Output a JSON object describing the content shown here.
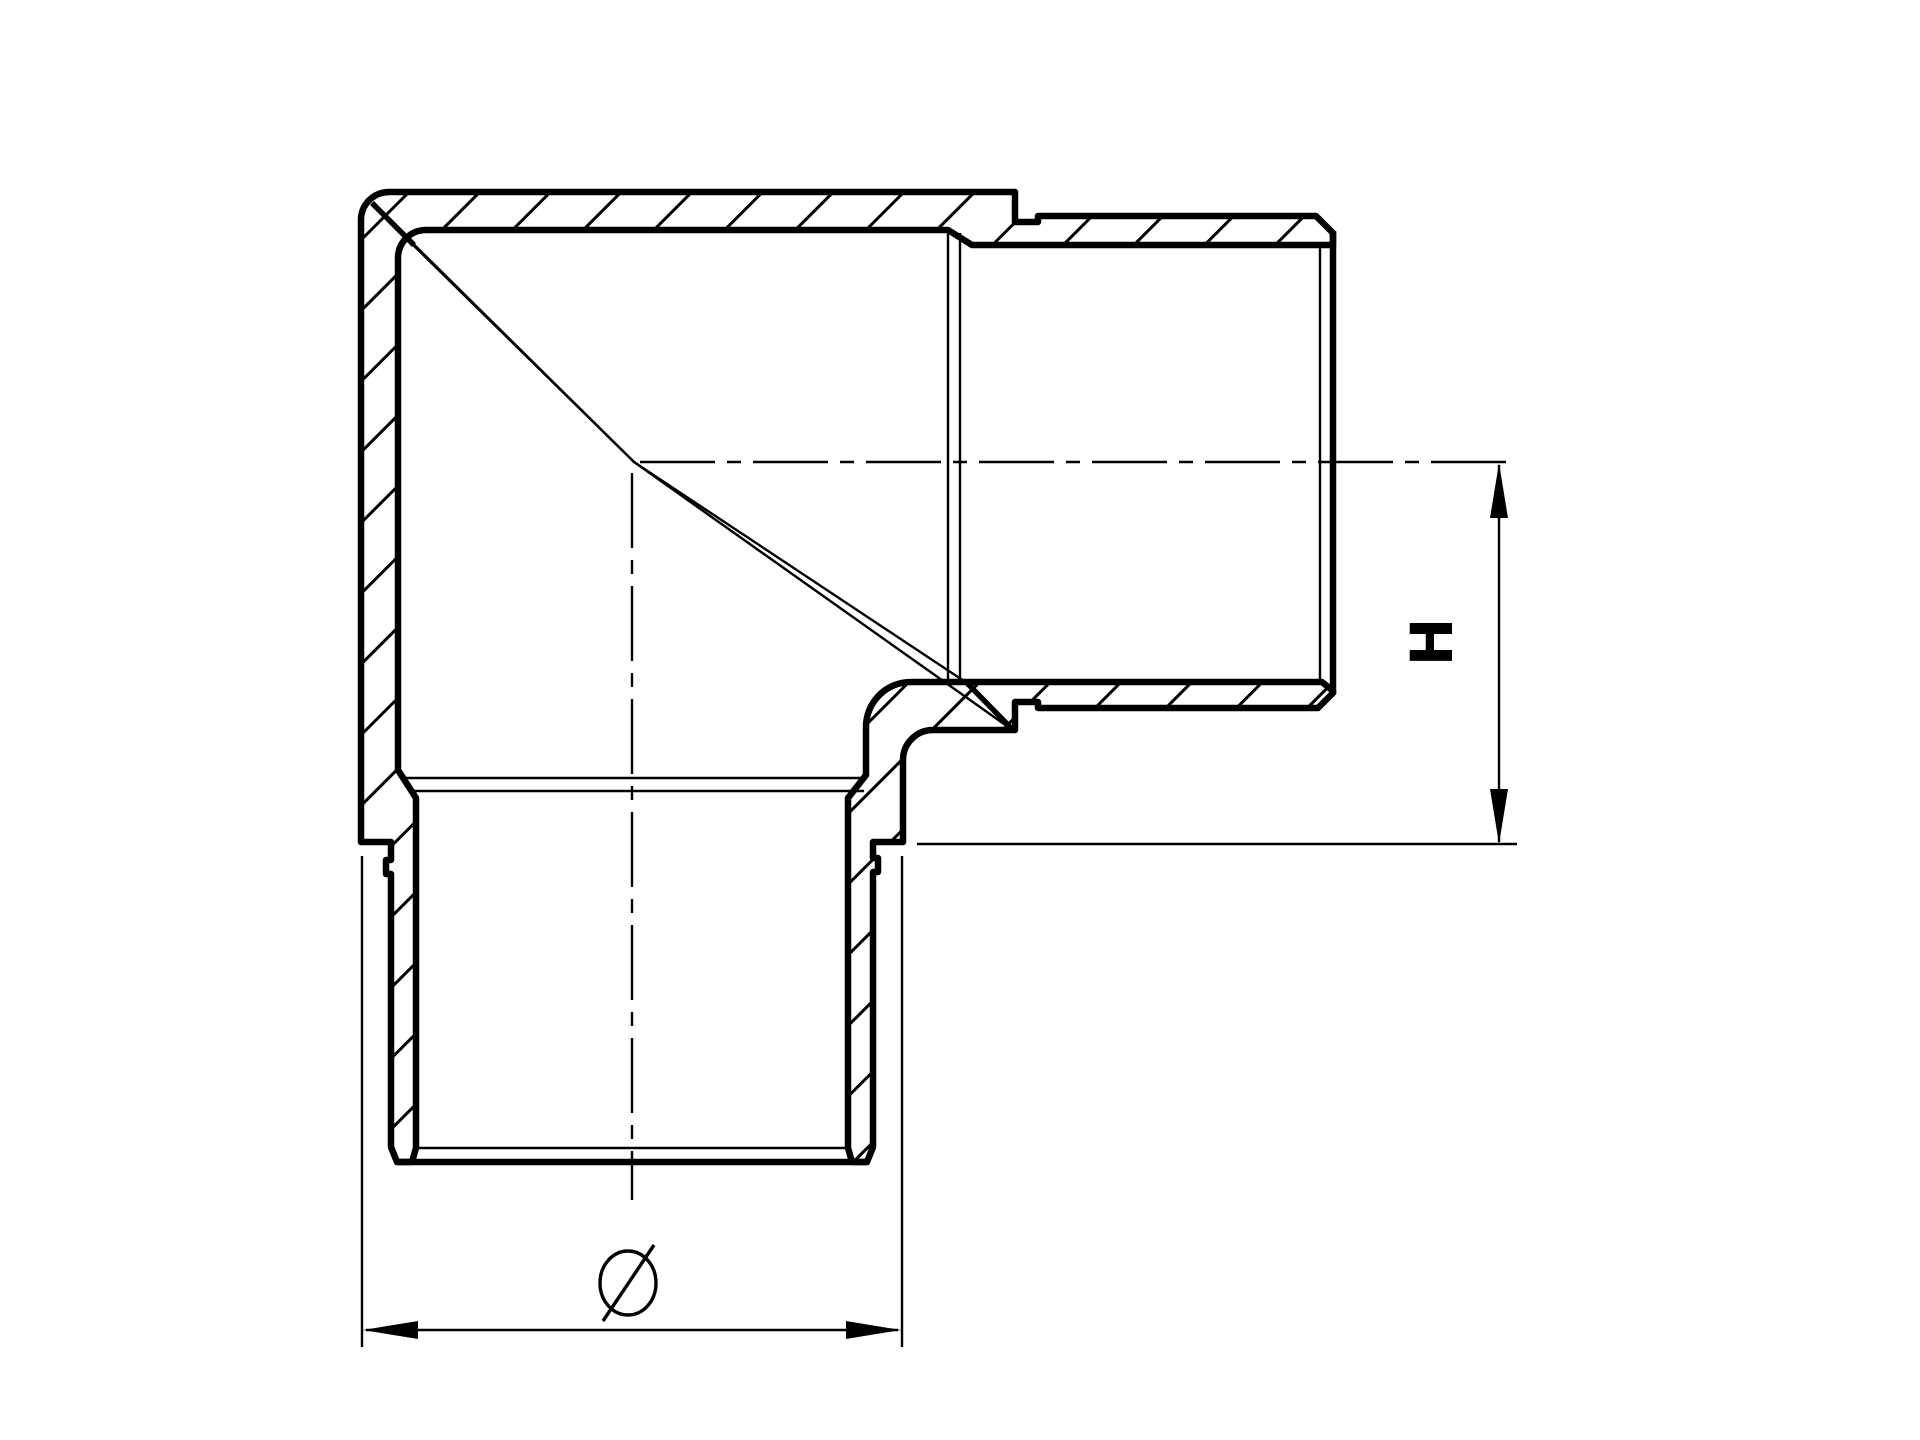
{
  "drawing": {
    "description": "Cross-section technical drawing of a 90-degree flush elbow tube fitting with two spigot ends",
    "background_color": "#ffffff",
    "line_color": "#000000",
    "dimension_labels": {
      "height": "H",
      "diameter": "Ø"
    }
  }
}
